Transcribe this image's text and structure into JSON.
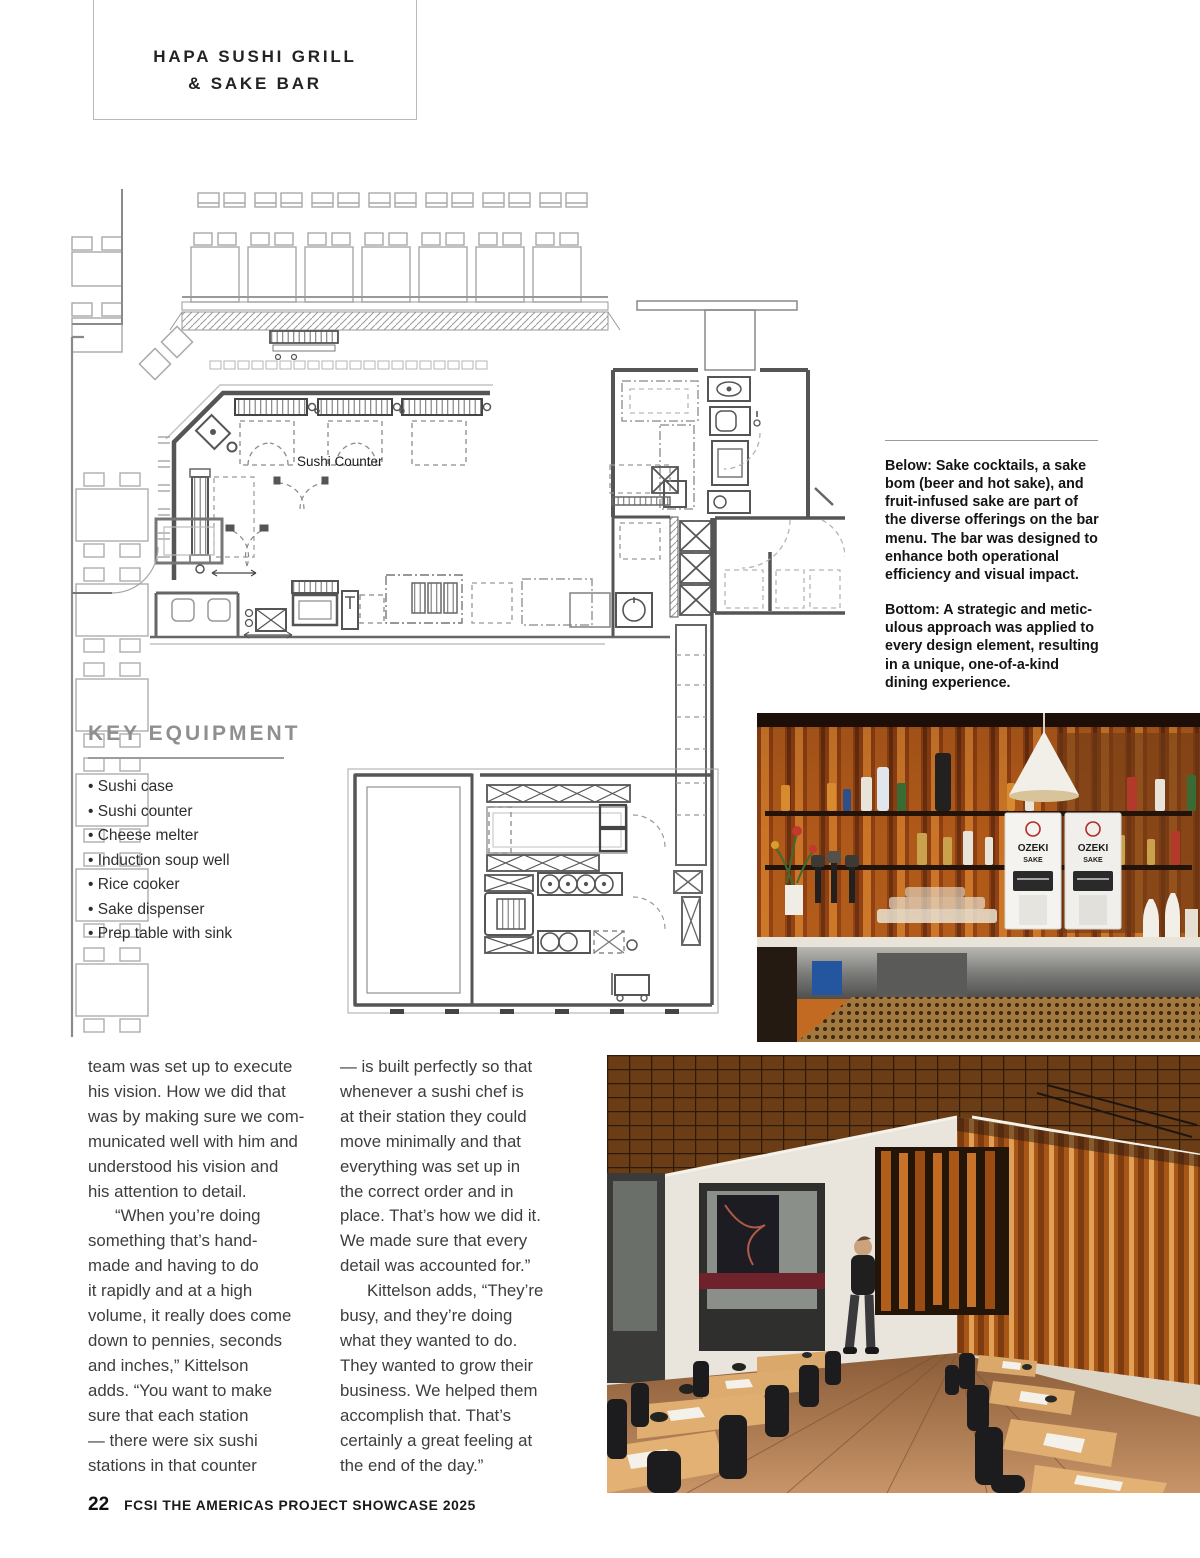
{
  "header": {
    "title_lines": [
      "HAPA SUSHI GRILL",
      "& SAKE BAR"
    ]
  },
  "floor_plan": {
    "counter_label": "Sushi Counter"
  },
  "captions": {
    "below_lines": [
      "Below: Sake cocktails, a sake",
      "bom (beer and hot sake), and",
      "fruit-infused sake are part of",
      "the diverse offerings on the bar",
      "menu. The bar was designed to",
      "enhance both operational",
      "efficiency and visual impact."
    ],
    "bottom_lines": [
      "Bottom: A strategic and metic-",
      "ulous approach was applied to",
      "every design element, resulting",
      "in a unique, one-of-a-kind",
      "dining experience."
    ]
  },
  "key_equipment": {
    "heading": "KEY EQUIPMENT",
    "items": [
      "Sushi case",
      "Sushi counter",
      "Cheese melter",
      "Induction soup well",
      "Rice cooker",
      "Sake dispenser",
      "Prep table with sink"
    ]
  },
  "article": {
    "col1_p1_lines": [
      "team was set up to execute",
      "his vision. How we did that",
      "was by making sure we com-",
      "municated well with him and",
      "understood his vision and",
      "his attention to detail."
    ],
    "col1_p2_lines": [
      "“When you’re doing",
      "something that’s hand-",
      "made and having to do",
      "it rapidly and at a high",
      "volume, it really does come",
      "down to pennies, seconds",
      "and inches,” Kittelson",
      "adds. “You want to make",
      "sure that each station",
      "— there were six sushi",
      "stations in that counter"
    ],
    "col2_p1_lines": [
      "— is built perfectly so that",
      "whenever a sushi chef is",
      "at their station they could",
      "move minimally and that",
      "everything was set up in",
      "the correct order and in",
      "place. That’s how we did it.",
      "We made sure that every",
      "detail was accounted for.”"
    ],
    "col2_p2_lines": [
      "Kittelson adds, “They’re",
      "busy, and they’re doing",
      "what they wanted to do.",
      "They wanted to grow their",
      "business. We helped them",
      "accomplish that. That’s",
      "certainly a great feeling at",
      "the end of the day.”"
    ]
  },
  "photos": {
    "bar": {
      "dispenser_brand": "OZEKI",
      "dispenser_type": "SAKE"
    }
  },
  "footer": {
    "page_number": "22",
    "publication": "FCSI THE AMERICAS PROJECT SHOWCASE 2025"
  },
  "colors": {
    "accent_wood": "#b96a28",
    "plan_wall": "#4a4a4a",
    "heading_gray": "#8f8f8f"
  }
}
